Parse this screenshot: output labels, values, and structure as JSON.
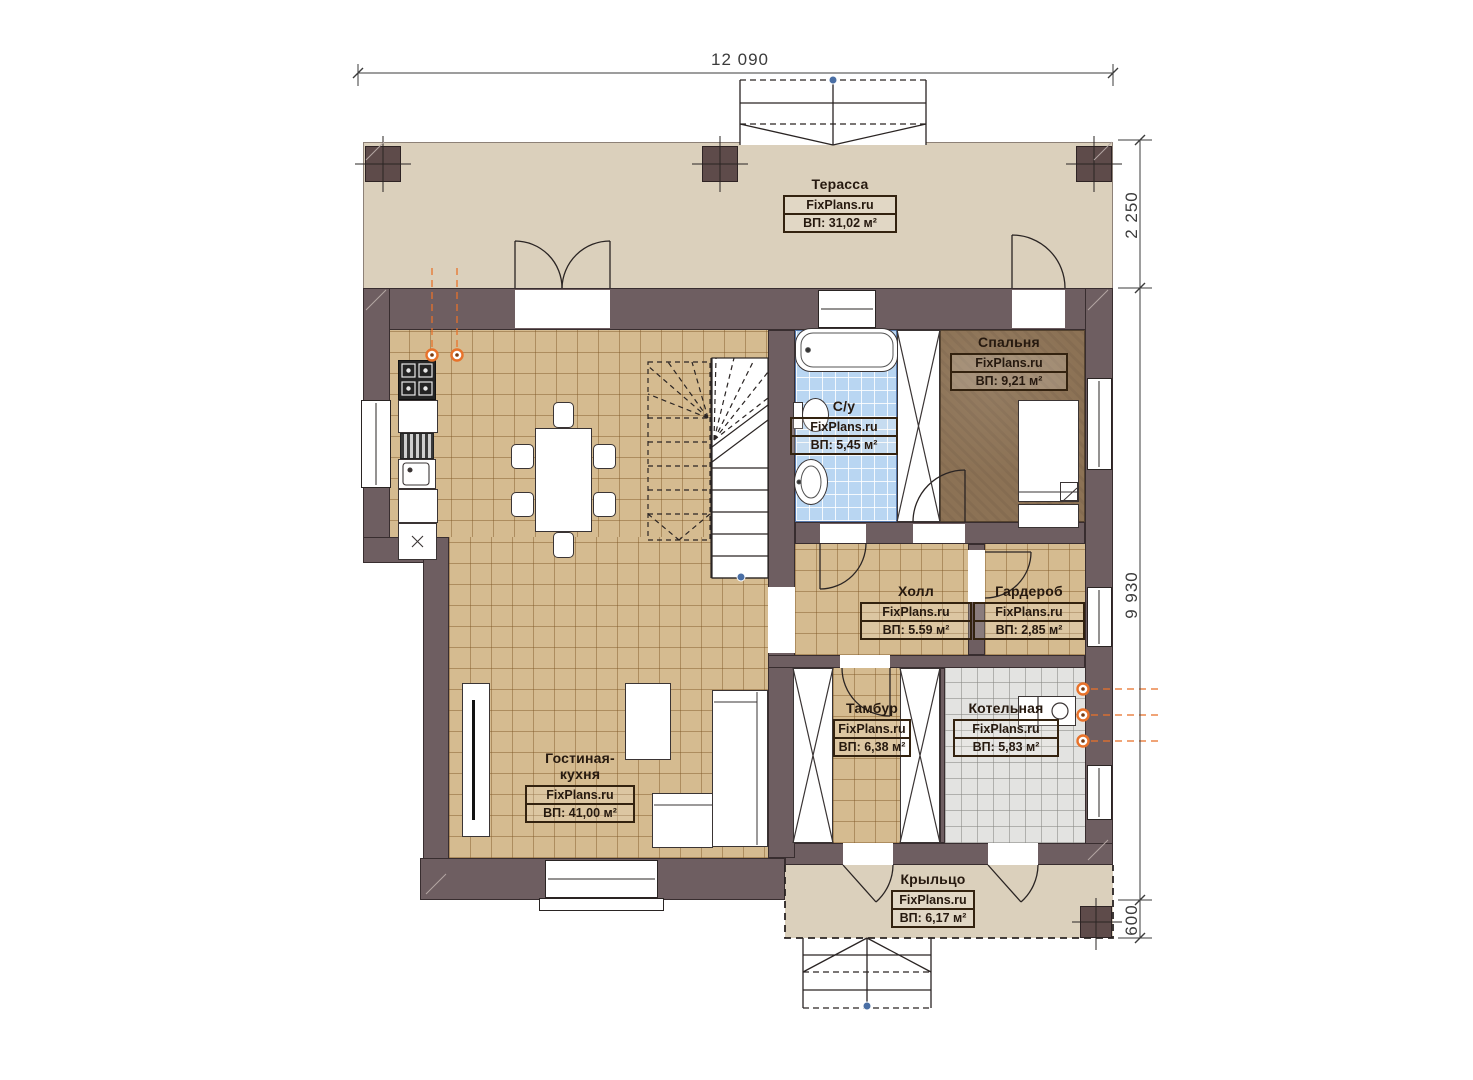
{
  "watermark": "FixPlans.ru",
  "dimensions": {
    "width_top": "12 090",
    "terrace_depth": "2 250",
    "house_depth": "9 930",
    "porch_depth": "600"
  },
  "rooms": [
    {
      "id": "terrace",
      "name": "Терасса",
      "area": "ВП: 31,02 м²"
    },
    {
      "id": "bedroom",
      "name": "Спальня",
      "area": "ВП: 9,21 м²"
    },
    {
      "id": "bathroom",
      "name": "С/у",
      "area": "ВП: 5,45 м²"
    },
    {
      "id": "hall",
      "name": "Холл",
      "area": "ВП: 5.59 м²"
    },
    {
      "id": "wardrobe",
      "name": "Гардероб",
      "area": "ВП: 2,85 м²"
    },
    {
      "id": "vestibule",
      "name": "Тамбур",
      "area": "ВП: 6,38 м²"
    },
    {
      "id": "boiler",
      "name": "Котельная",
      "area": "ВП: 5,83 м²"
    },
    {
      "id": "living",
      "name": "Гостиная-кухня",
      "area": "ВП: 41,00 м²"
    },
    {
      "id": "porch",
      "name": "Крыльцо",
      "area": "ВП: 6,17 м²"
    }
  ],
  "colors": {
    "wall": "#6e5e61",
    "terrace": "#dbd0bc",
    "floor_tan": "#d5bb90",
    "floor_blue": "#b9d6f2",
    "floor_gray": "#e3e3e1",
    "floor_bedroom": "#8c7255",
    "accent_orange": "#e8722a",
    "marker_blue": "#4a6fa5",
    "dim": "#3b3b3b",
    "label": "#26190f"
  }
}
